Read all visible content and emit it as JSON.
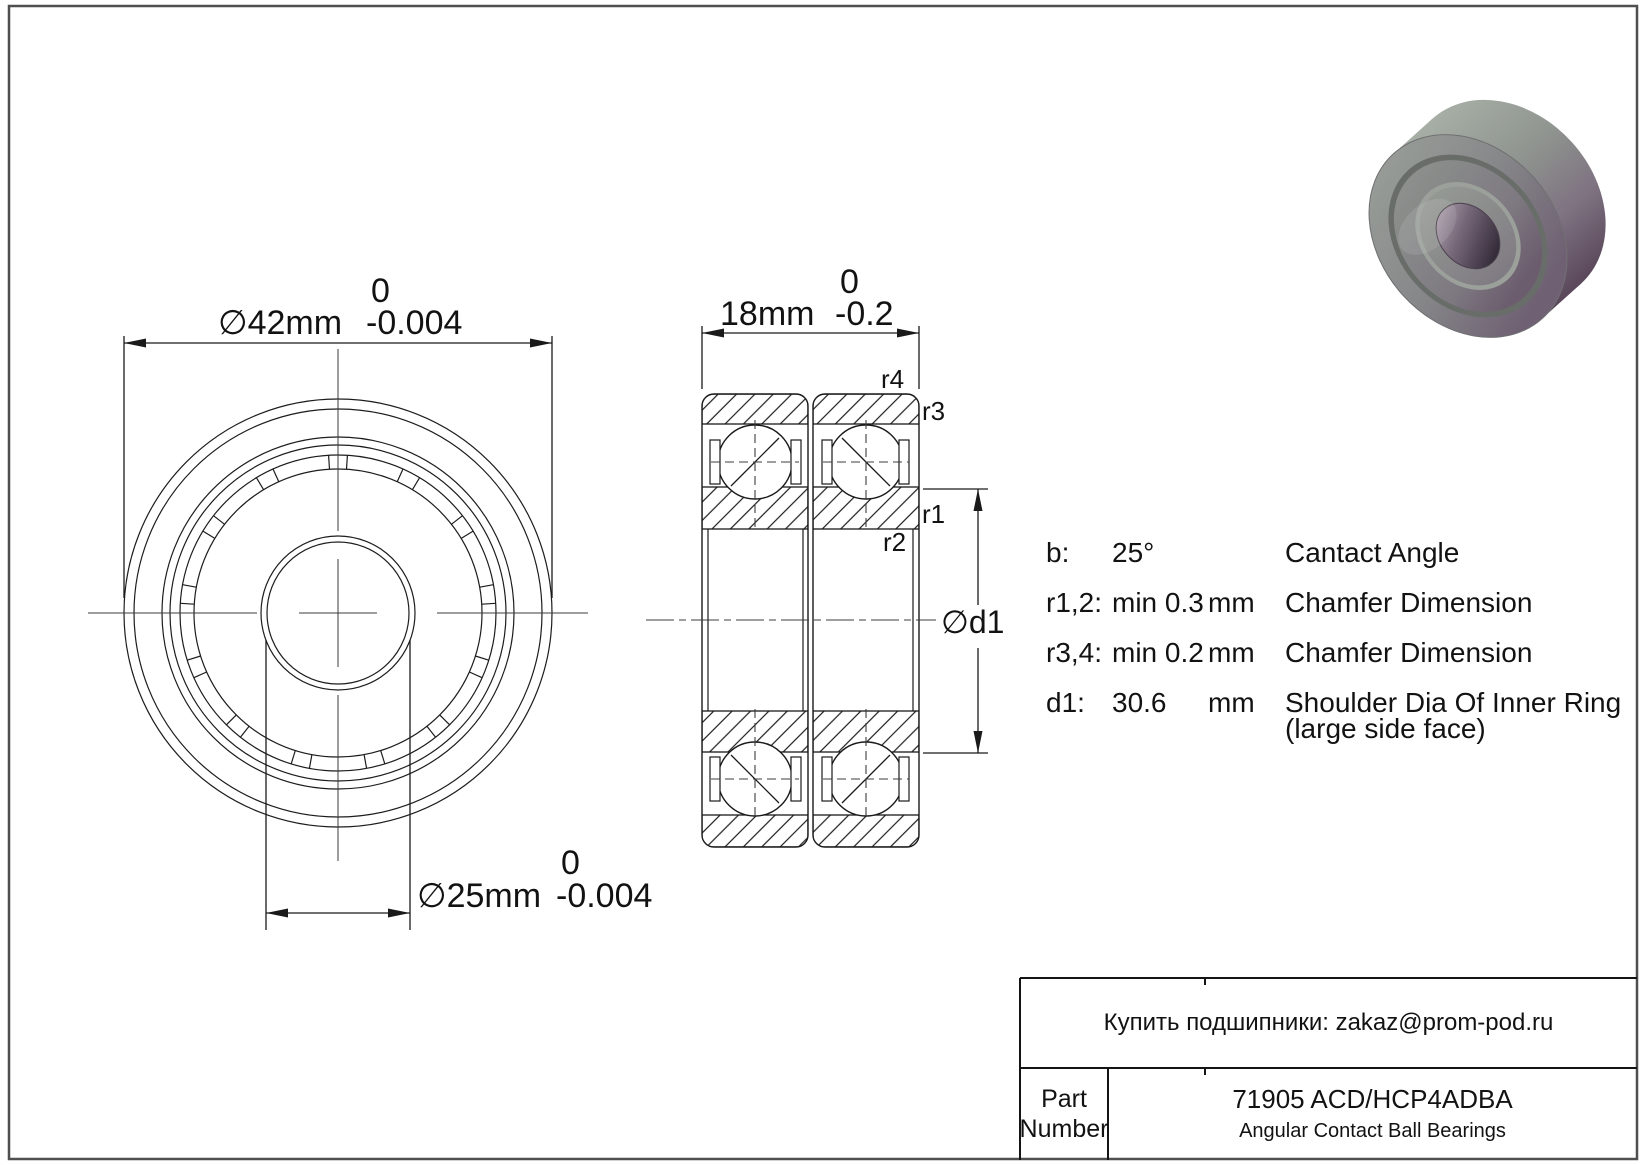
{
  "page": {
    "background": "#ffffff",
    "border_color": "#4f4f4f"
  },
  "front_view": {
    "od_dimension": {
      "value": "∅42mm",
      "tol_top": "0",
      "tol_bottom": "-0.004"
    },
    "bore_dimension": {
      "value": "∅25mm",
      "tol_top": "0",
      "tol_bottom": "-0.004"
    }
  },
  "section_view": {
    "width_dimension": {
      "value": "18mm",
      "tol_top": "0",
      "tol_bottom": "-0.2"
    },
    "d1_label": "∅d1",
    "r_labels": {
      "r1": "r1",
      "r2": "r2",
      "r3": "r3",
      "r4": "r4"
    }
  },
  "specs": {
    "rows": [
      {
        "label": "b:",
        "value": "25°",
        "unit": "",
        "desc": "Cantact Angle",
        "desc2": ""
      },
      {
        "label": "r1,2:",
        "value": "min 0.3",
        "unit": "mm",
        "desc": "Chamfer Dimension",
        "desc2": ""
      },
      {
        "label": "r3,4:",
        "value": "min 0.2",
        "unit": "mm",
        "desc": "Chamfer Dimension",
        "desc2": ""
      },
      {
        "label": "d1:",
        "value": "30.6",
        "unit": "mm",
        "desc": "Shoulder Dia Of Inner Ring",
        "desc2": "(large side face)"
      }
    ]
  },
  "title_block": {
    "contact": "Купить подшипники: zakaz@prom-pod.ru",
    "part_label_line1": "Part",
    "part_label_line2": "Number",
    "part_number": "71905 ACD/HCP4ADBA",
    "category": "Angular Contact Ball Bearings"
  },
  "colors": {
    "line": "#1a1a1a",
    "centerline": "#3c3c3c",
    "steel_light": "#9ba49c",
    "steel_mid": "#8b908c",
    "steel_purple": "#685366",
    "bore_dark": "#362d3b"
  }
}
